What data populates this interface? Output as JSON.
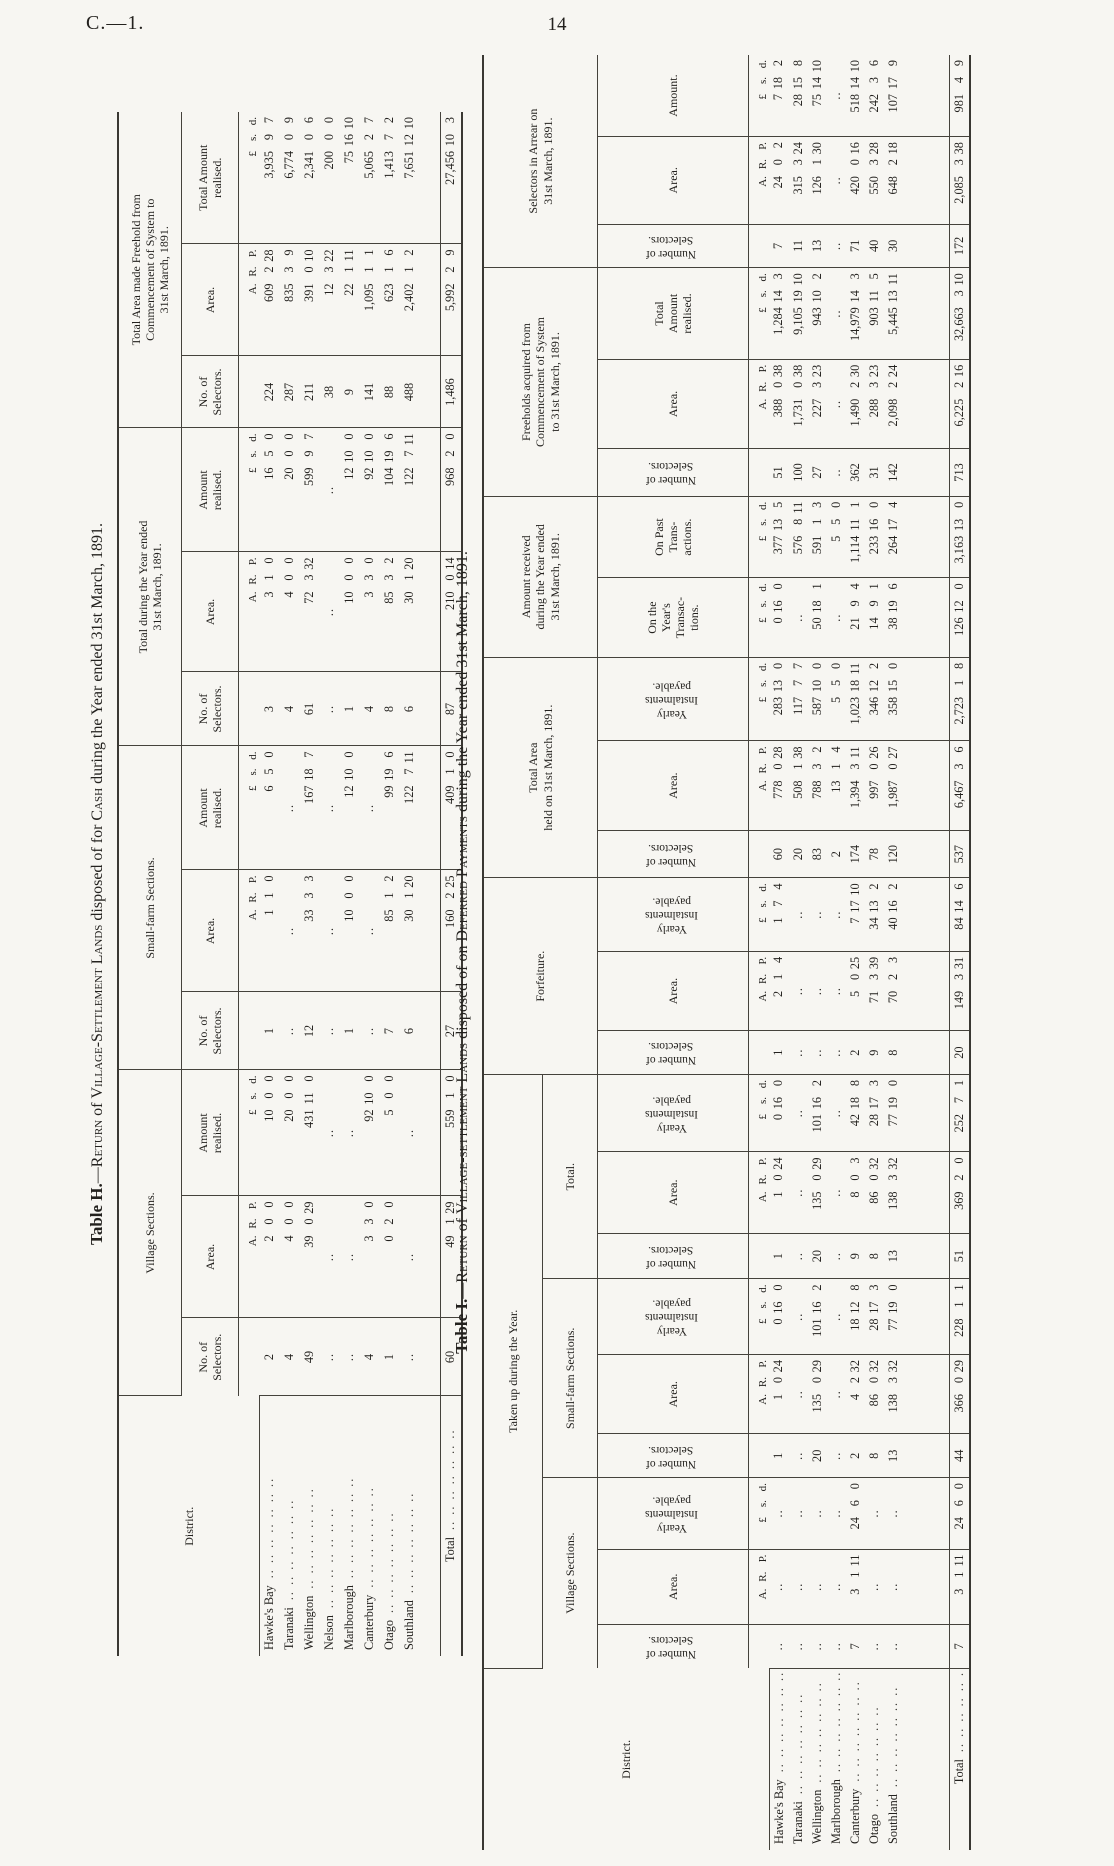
{
  "page": {
    "doc_ref": "C.—1.",
    "page_number": "14"
  },
  "units": {
    "area": "A. R. P.",
    "money": "£ s. d."
  },
  "leaders": ".. .. .. .. .. .. ..",
  "table_h": {
    "title": {
      "prefix": "Table H.",
      "dash": "—",
      "sc1": "Return",
      "m1": " of ",
      "sc2": "Village-Settlement Lands",
      "m2": " disposed of for ",
      "sc3": "Cash",
      "rest": " during the Year ended 31st March, 1891."
    },
    "headers": {
      "district": "District.",
      "groups": [
        {
          "label": "Village Sections.",
          "cols": [
            "No. of\nSelectors.",
            "Area.",
            "Amount\nrealised."
          ]
        },
        {
          "label": "Small-farm Sections.",
          "cols": [
            "No. of\nSelectors.",
            "Area.",
            "Amount\nrealised."
          ]
        },
        {
          "label": "Total during the Year ended\n31st March, 1891.",
          "cols": [
            "No. of\nSelectors.",
            "Area.",
            "Amount\nrealised."
          ]
        },
        {
          "label": "Total Area made Freehold from\nCommencement of System to\n31st March, 1891.",
          "cols": [
            "No. of\nSelectors.",
            "Area.",
            "Total Amount\nrealised."
          ]
        }
      ]
    },
    "rows": [
      {
        "district": "Hawke's Bay",
        "cells": [
          "2",
          "2 0 0",
          "10 0 0",
          "1",
          "1 1 0",
          "6 5 0",
          "3",
          "3 1 0",
          "16 5 0",
          "224",
          "609 2 28",
          "3,935 9 7"
        ]
      },
      {
        "district": "Taranaki",
        "cells": [
          "4",
          "4 0 0",
          "20 0 0",
          "..",
          "..",
          "..",
          "4",
          "4 0 0",
          "20 0 0",
          "287",
          "835 3 9",
          "6,774 0 9"
        ]
      },
      {
        "district": "Wellington",
        "cells": [
          "49",
          "39 0 29",
          "431 11 0",
          "12",
          "33 3 3",
          "167 18 7",
          "61",
          "72 3 32",
          "599 9 7",
          "211",
          "391 0 10",
          "2,341 0 6"
        ]
      },
      {
        "district": "Nelson",
        "cells": [
          "..",
          "..",
          "..",
          "..",
          "..",
          "..",
          "..",
          "..",
          "..",
          "38",
          "12 3 22",
          "200 0 0"
        ]
      },
      {
        "district": "Marlborough",
        "cells": [
          "..",
          "..",
          "..",
          "1",
          "10 0 0",
          "12 10 0",
          "1",
          "10 0 0",
          "12 10 0",
          "9",
          "22 1 11",
          "75 16 10"
        ]
      },
      {
        "district": "Canterbury",
        "cells": [
          "4",
          "3 3 0",
          "92 10 0",
          "..",
          "..",
          "..",
          "4",
          "3 3 0",
          "92 10 0",
          "141",
          "1,095 1 1",
          "5,065 2 7"
        ]
      },
      {
        "district": "Otago",
        "cells": [
          "1",
          "0 2 0",
          "5 0 0",
          "7",
          "85 1 2",
          "99 19 6",
          "8",
          "85 3 2",
          "104 19 6",
          "88",
          "623 1 6",
          "1,413 7 2"
        ]
      },
      {
        "district": "Southland",
        "cells": [
          "..",
          "..",
          "..",
          "6",
          "30 1 20",
          "122 7 11",
          "6",
          "30 1 20",
          "122 7 11",
          "488",
          "2,402 1 2",
          "7,651 12 10"
        ]
      }
    ],
    "total_row": {
      "district": "Total",
      "cells": [
        "60",
        "49 1 29",
        "559 1 0",
        "27",
        "160 2 25",
        "409 1 0",
        "87",
        "210 0 14",
        "968 2 0",
        "1,486",
        "5,992 2 9",
        "27,456 10 3"
      ]
    }
  },
  "table_i": {
    "title": {
      "prefix": "Table I.",
      "dash": "—",
      "sc1": "Return",
      "m1": " of ",
      "sc2": "Village-settlement Lands",
      "m2": " disposed of on ",
      "sc3": "Deferred Payments",
      "rest": " during the Year ended 31st March, 1891."
    },
    "headers": {
      "district": "District.",
      "taken_up": "Taken up during the Year.",
      "groups_top": [
        "Forfeiture.",
        "Total Area\nheld on 31st March, 1891.",
        "Amount received\nduring the Year ended\n31st March, 1891.",
        "Freeholds acquired from\nCommencement of System\nto 31st March, 1891.",
        "Selectors in Arrear on\n31st March, 1891."
      ],
      "sub_groups": [
        "Village Sections.",
        "Small-farm Sections.",
        "Total."
      ],
      "leaf": [
        "Number of\nSelectors.",
        "Area.",
        "Yearly\nInstalments\npayable.",
        "Number of\nSelectors.",
        "Area.",
        "Yearly\nInstalments\npayable.",
        "Number of\nSelectors.",
        "Area.",
        "Yearly\nInstalments\npayable.",
        "Number of\nSelectors.",
        "Area.",
        "Yearly\nInstalments\npayable.",
        "Number of\nSelectors.",
        "Area.",
        "Yearly\nInstalments\npayable.",
        "On the\nYear's\nTransac-\ntions.",
        "On Past\nTrans-\nactions.",
        "Number of\nSelectors.",
        "Area.",
        "Total\nAmount\nrealised.",
        "Number of\nSelectors.",
        "Area.",
        "Amount."
      ]
    },
    "rows": [
      {
        "district": "Hawke's Bay",
        "cells": [
          "..",
          "..",
          "..",
          "1",
          "1 0 24",
          "0 16 0",
          "1",
          "1 0 24",
          "0 16 0",
          "1",
          "2 1 4",
          "1 7 4",
          "60",
          "778 0 28",
          "283 13 0",
          "0 16 0",
          "377 13 5",
          "51",
          "388 0 38",
          "1,284 14 3",
          "7",
          "24 0 2",
          "7 18 2"
        ]
      },
      {
        "district": "Taranaki",
        "cells": [
          "..",
          "..",
          "..",
          "..",
          "..",
          "..",
          "..",
          "..",
          "..",
          "..",
          "..",
          "..",
          "20",
          "508 1 38",
          "117 7 7",
          "..",
          "576 8 11",
          "100",
          "1,731 0 38",
          "9,105 19 10",
          "11",
          "315 3 24",
          "28 15 8"
        ]
      },
      {
        "district": "Wellington",
        "cells": [
          "..",
          "..",
          "..",
          "20",
          "135 0 29",
          "101 16 2",
          "20",
          "135 0 29",
          "101 16 2",
          "..",
          "..",
          "..",
          "83",
          "788 3 2",
          "587 10 0",
          "50 18 1",
          "591 1 3",
          "27",
          "227 3 23",
          "943 10 2",
          "13",
          "126 1 30",
          "75 14 10"
        ]
      },
      {
        "district": "Marlborough",
        "cells": [
          "..",
          "..",
          "..",
          "..",
          "..",
          "..",
          "..",
          "..",
          "..",
          "..",
          "..",
          "..",
          "2",
          "13 1 4",
          "5 5 0",
          "..",
          "5 5 0",
          "..",
          "..",
          "..",
          "..",
          "..",
          ".."
        ]
      },
      {
        "district": "Canterbury",
        "cells": [
          "7",
          "3 1 11",
          "24 6 0",
          "2",
          "4 2 32",
          "18 12 8",
          "9",
          "8 0 3",
          "42 18 8",
          "2",
          "5 0 25",
          "7 17 10",
          "174",
          "1,394 3 11",
          "1,023 18 11",
          "21 9 4",
          "1,114 11 1",
          "362",
          "1,490 2 30",
          "14,979 14 3",
          "71",
          "420 0 16",
          "518 14 10"
        ]
      },
      {
        "district": "Otago",
        "cells": [
          "..",
          "..",
          "..",
          "8",
          "86 0 32",
          "28 17 3",
          "8",
          "86 0 32",
          "28 17 3",
          "9",
          "71 3 39",
          "34 13 2",
          "78",
          "997 0 26",
          "346 12 2",
          "14 9 1",
          "233 16 0",
          "31",
          "288 3 23",
          "903 11 5",
          "40",
          "550 3 28",
          "242 3 6"
        ]
      },
      {
        "district": "Southland",
        "cells": [
          "..",
          "..",
          "..",
          "13",
          "138 3 32",
          "77 19 0",
          "13",
          "138 3 32",
          "77 19 0",
          "8",
          "70 2 3",
          "40 16 2",
          "120",
          "1,987 0 27",
          "358 15 0",
          "38 19 6",
          "264 17 4",
          "142",
          "2,098 2 24",
          "5,445 13 11",
          "30",
          "648 2 18",
          "107 17 9"
        ]
      }
    ],
    "total_row": {
      "district": "Total",
      "cells": [
        "7",
        "3 1 11",
        "24 6 0",
        "44",
        "366 0 29",
        "228 1 1",
        "51",
        "369 2 0",
        "252 7 1",
        "20",
        "149 3 31",
        "84 14 6",
        "537",
        "6,467 3 6",
        "2,723 1 8",
        "126 12 0",
        "3,163 13 0",
        "713",
        "6,225 2 16",
        "32,663 3 10",
        "172",
        "2,085 3 38",
        "981 4 9"
      ]
    }
  }
}
